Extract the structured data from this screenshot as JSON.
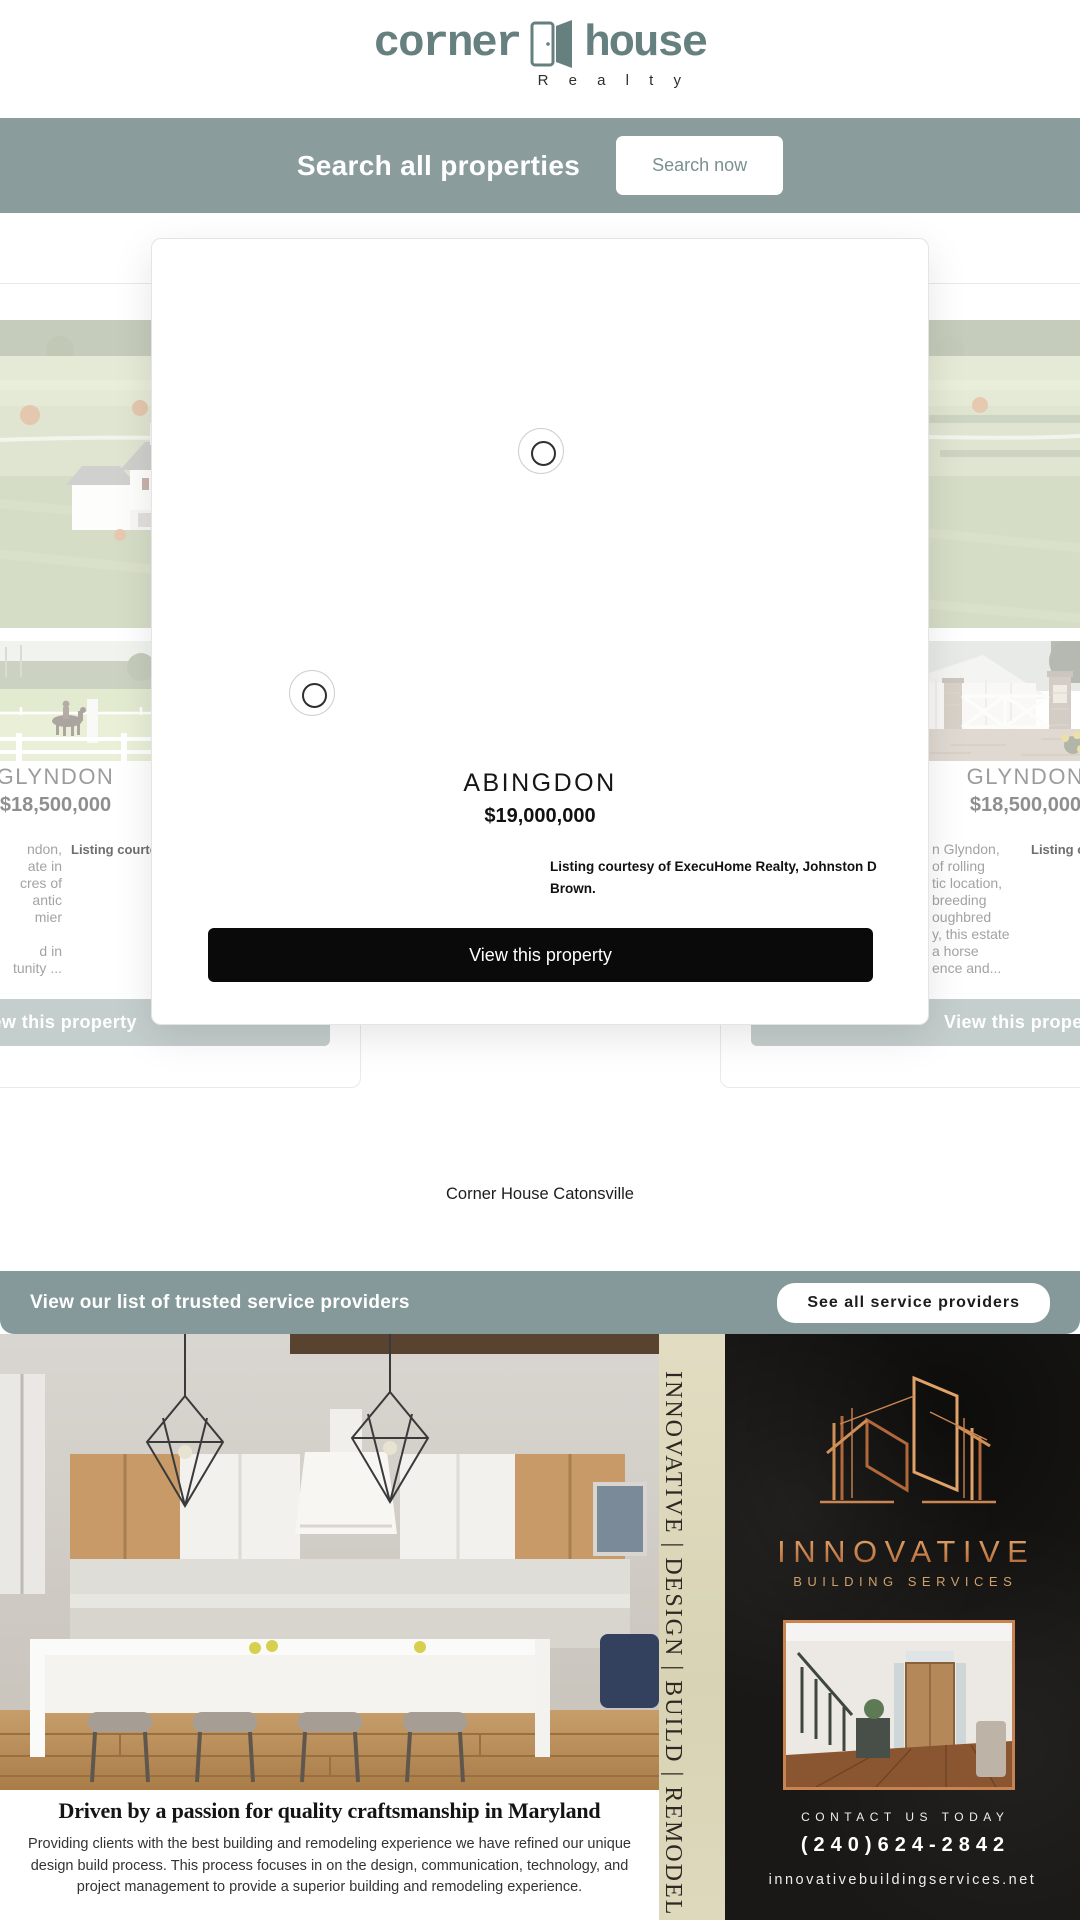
{
  "colors": {
    "sage": "#8a9c9b",
    "sage_muted_button": "#c4cecd",
    "logo_teal": "#66807f",
    "modal_button_black": "#0a0a0a",
    "copper": "#c98350",
    "cream_strip": "#ded9bd",
    "dark_panel": "#191816"
  },
  "header": {
    "logo_part1": "corner",
    "logo_part2": "house",
    "logo_sub": "R e a l t y"
  },
  "search_banner": {
    "label": "Search all properties",
    "button": "Search now"
  },
  "modal": {
    "title": "ABINGDON",
    "price": "$19,000,000",
    "listing_courtesy": "Listing courtesy of ExecuHome Realty, Johnston D Brown.",
    "button": "View this property"
  },
  "left_card": {
    "title": "GLYNDON",
    "price": "$18,500,000",
    "listing_courtesy": "Listing courtesy of",
    "desc_lines": [
      "ndon,",
      "ate in",
      "cres of",
      "antic",
      "mier",
      "",
      "d in",
      "tunity ..."
    ],
    "button": "View this property"
  },
  "right_card": {
    "title": "GLYNDON",
    "price": "$18,500,000",
    "listing_courtesy": "Listing courtesy of",
    "desc_lines": [
      "n Glyndon,",
      "of rolling",
      "tic location,",
      "breeding",
      "oughbred",
      "y, this estate",
      "a horse",
      "ence and..."
    ],
    "button": "View this property"
  },
  "catonsville": {
    "label": "Corner House Catonsville"
  },
  "service_banner": {
    "label": "View our list of trusted service providers",
    "button": "See all service providers"
  },
  "ad": {
    "vertical_text": "INNOVATIVE | DESIGN | BUILD | REMODEL",
    "headline": "Driven by a passion for quality craftsmanship in Maryland",
    "paragraph": "Providing clients with the best building and remodeling experience we have refined our unique design build process. This process focuses in on the design, communication, technology, and project management to provide a superior building and remodeling experience.",
    "brand": "INNOVATIVE",
    "brand_sub": "BUILDING SERVICES",
    "contact_label": "CONTACT US TODAY",
    "phone": "(240)624-2842",
    "website": "innovativebuildingservices.net"
  }
}
